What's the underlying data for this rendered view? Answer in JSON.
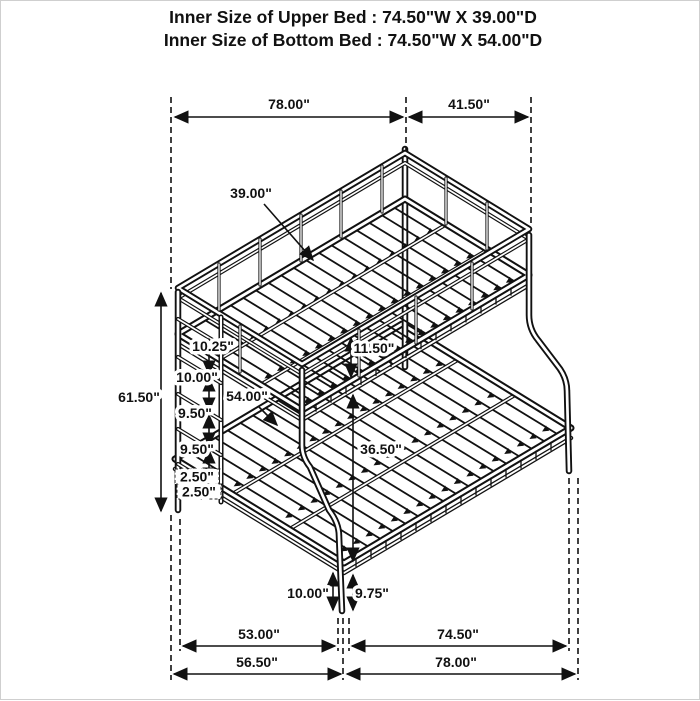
{
  "title": {
    "line1": "Inner Size of Upper Bed : 74.50\"W X 39.00\"D",
    "line2": "Inner Size of Bottom Bed : 74.50\"W X 54.00\"D"
  },
  "dims": {
    "top_length": "78.00\"",
    "top_depth": "41.50\"",
    "upper_bed_depth": "39.00\"",
    "overall_height": "61.50\"",
    "ladder_step_1": "10.25\"",
    "ladder_step_2": "10.00\"",
    "ladder_step_3": "9.50\"",
    "ladder_step_4": "9.50\"",
    "ladder_step_5": "2.50\"",
    "ladder_step_6": "2.50\"",
    "guardrail_height": "11.50\"",
    "lower_bed_depth": "54.00\"",
    "under_clearance": "36.50\"",
    "front_leg_left": "10.00\"",
    "front_leg_right": "9.75\"",
    "bottom_inner_left": "53.00\"",
    "bottom_inner_right": "74.50\"",
    "bottom_outer_left": "56.50\"",
    "bottom_outer_right": "78.00\""
  },
  "colors": {
    "line": "#111111",
    "background": "#ffffff"
  }
}
